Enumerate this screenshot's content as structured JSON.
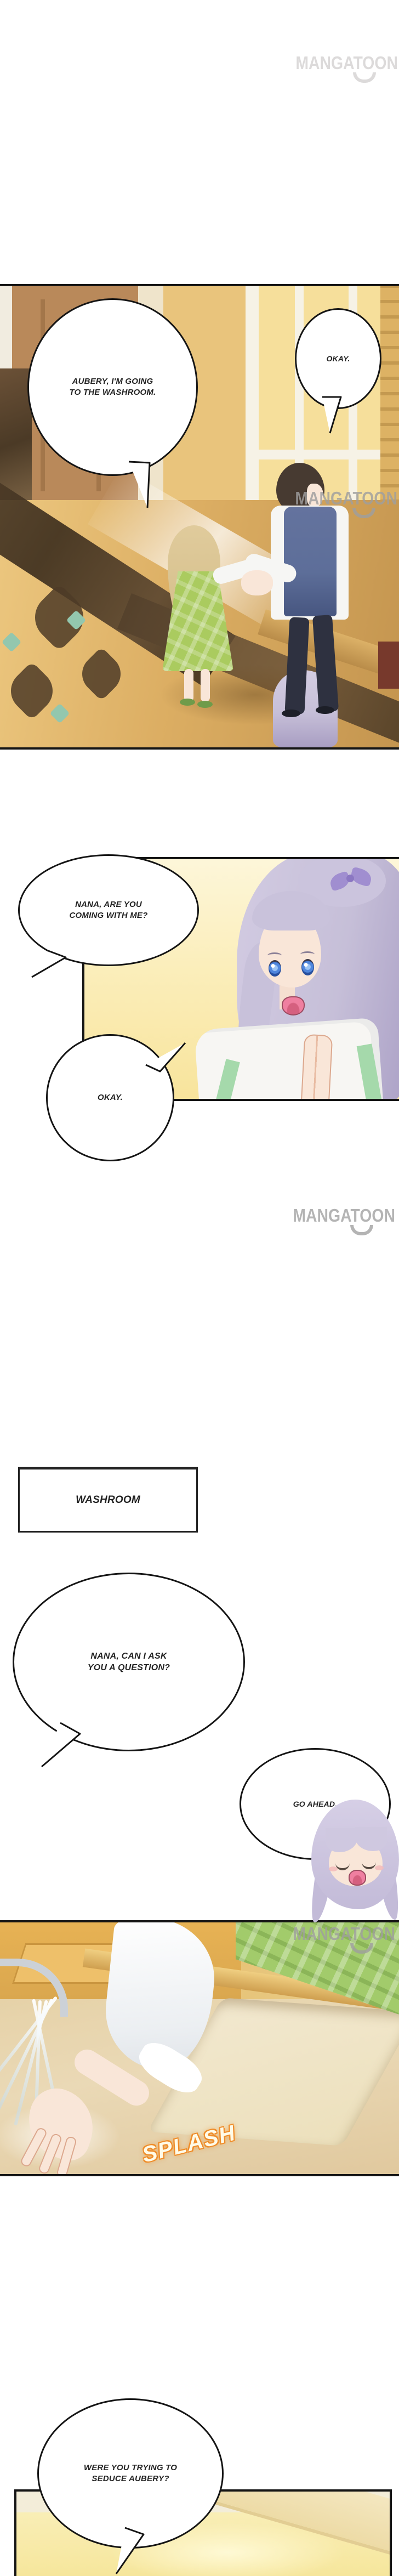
{
  "watermark": {
    "text": "MANGATOON"
  },
  "speech": {
    "aubery_going": {
      "line1": "AUBERY, I'M GOING",
      "line2": "TO THE WASHROOM."
    },
    "okay_hall": {
      "text": "OKAY."
    },
    "nana_coming": {
      "line1": "NANA, ARE YOU",
      "line2": "COMING WITH ME?"
    },
    "okay_nana": {
      "text": "OKAY."
    },
    "washroom_sign": {
      "text": "WASHROOM"
    },
    "nana_question": {
      "line1": "NANA, CAN I ASK",
      "line2": "YOU A QUESTION?"
    },
    "go_ahead": {
      "text": "GO AHEAD."
    },
    "splash_sfx": {
      "text": "SPLASH"
    },
    "seduce_question": {
      "line1": "WERE YOU TRYING TO",
      "line2": "SEDUCE AUBERY?"
    }
  },
  "colors": {
    "ink": "#151515",
    "paper": "#ffffff",
    "watermark-gray": "#9f9f9f",
    "watermark-faint": "#dcdada",
    "wood-brown": "#b9895a",
    "floor-gold": "#dcae63",
    "teal-accent": "#93c7ae",
    "glass-yellow": "#f6df9b",
    "frame-white": "#f6f2e6",
    "hair-blonde": "#d8c28f",
    "dress-green": "#aacb5f",
    "vest-blue": "#5d6e99",
    "pants-dark": "#2e3140",
    "hair-dark": "#473a31",
    "shirt-white": "#f6f6f4",
    "skin": "#f9e6d8",
    "bg-cream": "#fdf6d9",
    "bg-gold": "#f8e49c",
    "hair-lavender": "#c6bfd8",
    "bow-purple": "#a08ed0",
    "eye-blue": "#4f86dd",
    "mouth-pink": "#ef7fa0",
    "robe-white": "#f7f6f3",
    "robe-green": "#a5d9ab",
    "bath-gold": "#eec169",
    "bath-amber": "#d9a64e",
    "counter-beige": "#ead9b6",
    "sink-cream": "#f2e8cf",
    "curtain-green": "#a2cb6b",
    "splash-orange": "#ef8d2a",
    "ceiling-cream": "#f3edd9",
    "room-yellow": "#f9eeb6",
    "blush-pink": "#f3bdbd"
  }
}
